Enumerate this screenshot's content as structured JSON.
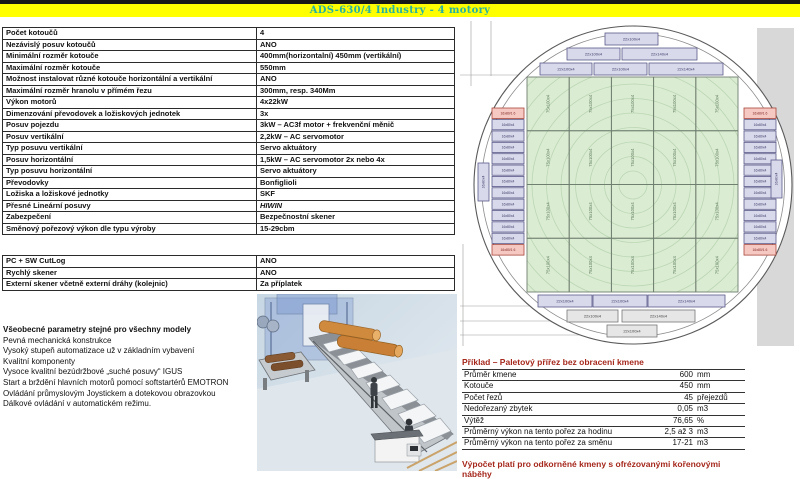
{
  "header": {
    "title": "ADS-630/4 Industry - 4 motory"
  },
  "spec_table": {
    "rows": [
      {
        "label": "Počet kotoučů",
        "value": "4"
      },
      {
        "label": "Nezávislý posuv kotoučů",
        "value": "ANO"
      },
      {
        "label": "Minimální rozměr kotouče",
        "value": "400mm(horizontalní) 450mm (vertikální)"
      },
      {
        "label": "Maximální rozměr kotouče",
        "value": "550mm"
      },
      {
        "label": "Možnost instalovat různé kotouče horizontální a vertikální",
        "value": "ANO"
      },
      {
        "label": "Maximální rozměr hranolu v přímém řezu",
        "value": "300mm, resp. 340Mm"
      },
      {
        "label": "Výkon motorů",
        "value": "4x22kW"
      },
      {
        "label": "Dimenzování převodovek a ložiskových jednotek",
        "value": "3x"
      },
      {
        "label": "Posuv pojezdu",
        "value": "3kW – AC3f motor + frekvenční měnič"
      },
      {
        "label": "Posuv vertikální",
        "value": "2,2kW – AC servomotor"
      },
      {
        "label": "Typ posuvu vertikální",
        "value": "Servo aktuátory"
      },
      {
        "label": "Posuv horizontální",
        "value": "1,5kW – AC servomotor  2x nebo 4x"
      },
      {
        "label": "Typ posuvu horizontální",
        "value": "Servo aktuátory"
      },
      {
        "label": "Převodovky",
        "value": "Bonfiglioli"
      },
      {
        "label": "Ložiska a ložiskové jednotky",
        "value": "SKF"
      },
      {
        "label": "Přesné Lineární posuvy",
        "value": "HIWIN",
        "italic": true
      },
      {
        "label": "Zabezpečení",
        "value": "Bezpečnostní skener"
      },
      {
        "label": "Směnový pořezový výkon dle typu výroby",
        "value": "15-29cbm"
      }
    ]
  },
  "options_table": {
    "rows": [
      {
        "label": "PC + SW CutLog",
        "value": "ANO"
      },
      {
        "label": "Rychlý skener",
        "value": "ANO"
      },
      {
        "label": "Externí skener včetně externí dráhy (kolejnic)",
        "value": "Za příplatek"
      }
    ]
  },
  "general_params": {
    "heading": "Všeobecné parametry stejné pro všechny modely",
    "items": [
      "Pevná mechanická konstrukce",
      "Vysoký stupeň automatizace už v základním vybavení",
      "Kvalitní komponenty",
      "Vysoce kvalitní bezúdržbové „suché posuvy“  IGUS",
      "Start a brždění hlavních motorů pomocí softstartérů EMOTRON",
      "Ovládání průmyslovým Joystickem a dotekovou obrazovkou",
      "Dálkové ovládání v automatickém režimu."
    ]
  },
  "example_table": {
    "title": "Příklad – Paletový přířez bez obracení kmene",
    "rows": [
      {
        "label": "Průměr kmene",
        "value": "600",
        "unit": "mm"
      },
      {
        "label": "Kotouče",
        "value": "450",
        "unit": "mm"
      },
      {
        "label": "Počet řezů",
        "value": "45",
        "unit": "přejezdů"
      },
      {
        "label": "Nedořezaný zbytek",
        "value": "0,05",
        "unit": "m3"
      },
      {
        "label": "Výtěž",
        "value": "76,65",
        "unit": "%"
      },
      {
        "label": "Průměrný výkon na tento pořez za hodinu",
        "value": "2,5 až 3",
        "unit": "m3"
      },
      {
        "label": "Průměrný výkon na tento pořez za směnu",
        "value": "17-21",
        "unit": "m3"
      }
    ],
    "note": "Výpočet platí pro odkorněné kmeny s ofrézovanými kořenovými náběhy"
  },
  "cutting_diagram": {
    "green_label": "75x100x4",
    "green_grid": {
      "x": 67,
      "y": 61,
      "cols": 5,
      "rows": 4,
      "cw": 42.2,
      "ch": 53.75
    },
    "h_boards": [
      {
        "x": 145,
        "y": 17,
        "w": 53,
        "h": 12,
        "label": "22x100x4",
        "type": "lavender"
      },
      {
        "x": 107,
        "y": 32,
        "w": 53,
        "h": 12,
        "label": "22x100x4",
        "type": "lavender"
      },
      {
        "x": 162,
        "y": 32,
        "w": 75,
        "h": 12,
        "label": "22x140x4",
        "type": "lavender"
      },
      {
        "x": 80,
        "y": 47,
        "w": 52,
        "h": 12,
        "label": "22x100x4",
        "type": "lavender"
      },
      {
        "x": 134,
        "y": 47,
        "w": 53,
        "h": 12,
        "label": "22x100x4",
        "type": "lavender"
      },
      {
        "x": 189,
        "y": 47,
        "w": 74,
        "h": 12,
        "label": "22x140x4",
        "type": "lavender"
      },
      {
        "x": 78,
        "y": 279,
        "w": 54,
        "h": 12,
        "label": "22x100x4",
        "type": "lavender"
      },
      {
        "x": 133,
        "y": 279,
        "w": 54,
        "h": 12,
        "label": "22x100x4",
        "type": "lavender"
      },
      {
        "x": 188,
        "y": 279,
        "w": 77,
        "h": 12,
        "label": "22x140x4",
        "type": "lavender"
      },
      {
        "x": 107,
        "y": 294,
        "w": 51,
        "h": 12,
        "label": "22x100x4",
        "type": "grey"
      },
      {
        "x": 162,
        "y": 294,
        "w": 73,
        "h": 12,
        "label": "22x140x4",
        "type": "grey"
      },
      {
        "x": 147,
        "y": 309,
        "w": 50,
        "h": 12,
        "label": "22x100x4",
        "type": "grey"
      }
    ],
    "stacks": {
      "left_x": 32,
      "right_x": 284,
      "w": 32,
      "top": 92,
      "red_label": "16x80/1 6",
      "purple_label": "16x80x4",
      "purple_count": 11
    },
    "edge_boards": [
      {
        "x": 18,
        "y": 147
      },
      {
        "x": 311,
        "y": 144
      }
    ],
    "edge_label": "16x80x4"
  },
  "colors": {
    "title_bg": "#ffff00",
    "title_text": "#26b2a2",
    "accent_red": "#a5281c",
    "board_green": "#daecd2",
    "board_lavender": "#d9d9ec",
    "board_grey": "#e6e6e6",
    "board_red": "#f5c9c2"
  }
}
